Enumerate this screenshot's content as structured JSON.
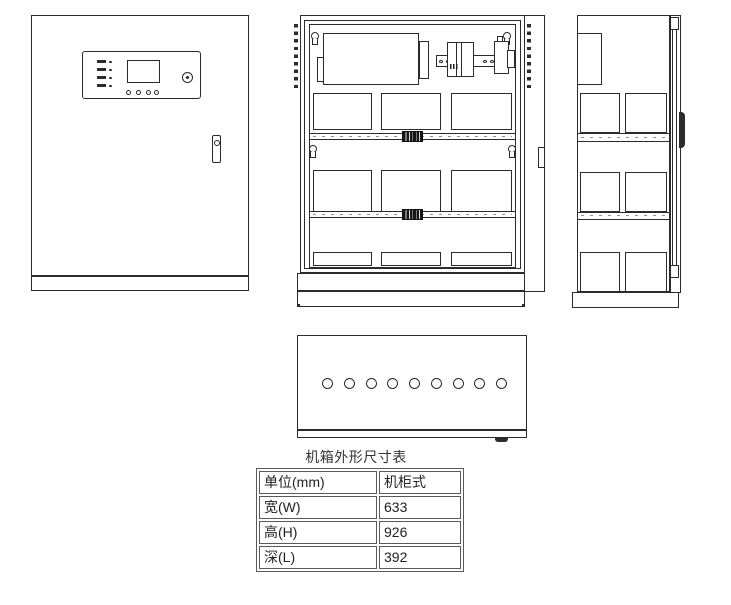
{
  "table": {
    "title": "机箱外形尺寸表",
    "rows": [
      {
        "label": "单位(mm)",
        "value": "机柜式"
      },
      {
        "label": "宽(W)",
        "value": "633"
      },
      {
        "label": "高(H)",
        "value": "926"
      },
      {
        "label": "深(L)",
        "value": "392"
      }
    ]
  },
  "bottom_view": {
    "cable_hole_count": 9
  },
  "colors": {
    "line": "#2b2b2b",
    "background": "#ffffff",
    "table_border": "#5a5a5a",
    "text": "#222222"
  }
}
